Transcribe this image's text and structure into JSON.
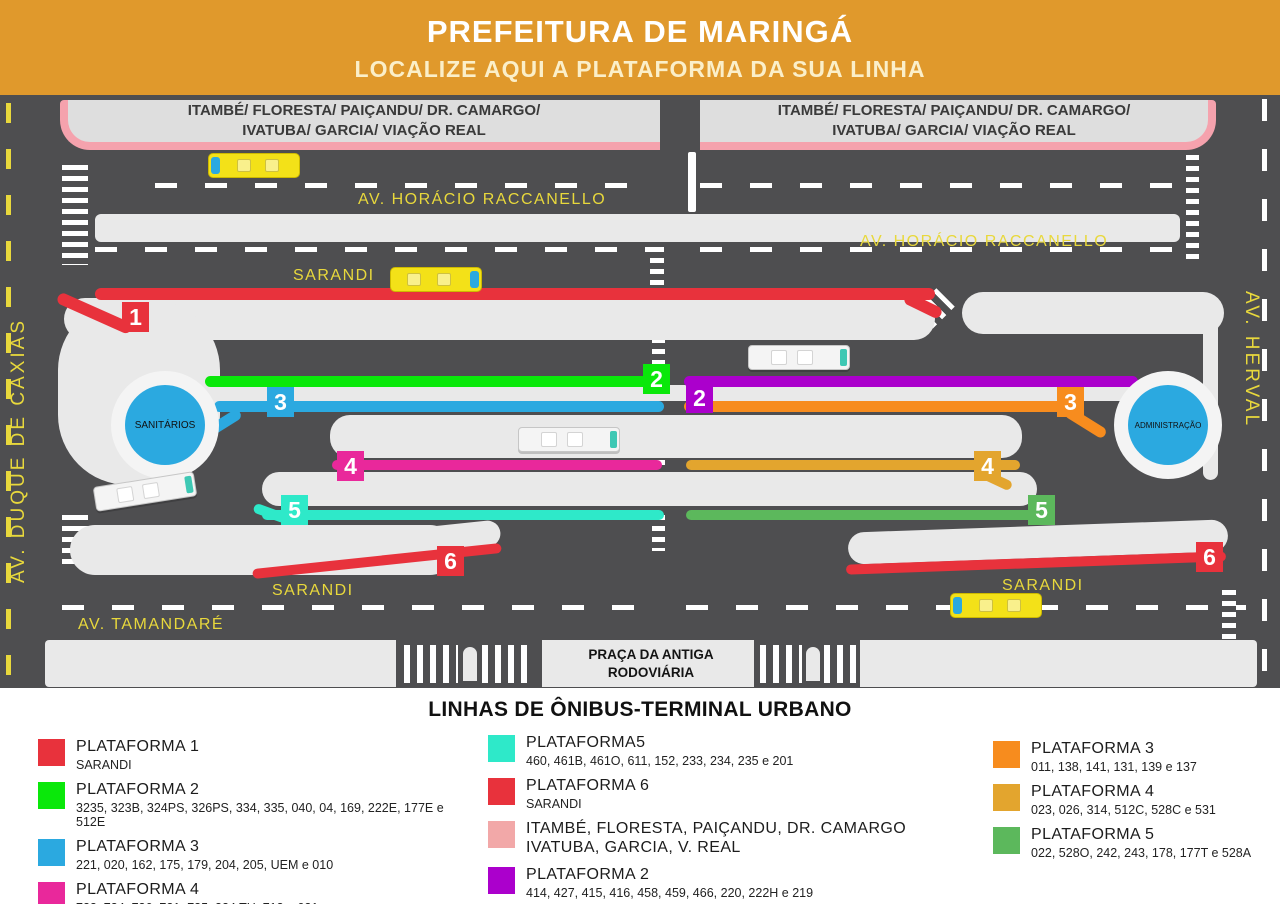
{
  "header": {
    "title": "PREFEITURA DE MARINGÁ",
    "subtitle": "LOCALIZE AQUI A PLATAFORMA DA SUA LINHA"
  },
  "map": {
    "banner_left": {
      "line1": "ITAMBÉ/ FLORESTA/ PAIÇANDU/ DR. CAMARGO/",
      "line2": "IVATUBA/ GARCIA/ VIAÇÃO REAL"
    },
    "banner_right": {
      "line1": "ITAMBÉ/ FLORESTA/ PAIÇANDU/ DR. CAMARGO/",
      "line2": "IVATUBA/ GARCIA/ VIAÇÃO REAL"
    },
    "streets": {
      "duque_de_caxias": "AV. DUQUE DE CAXIAS",
      "herval": "AV. HERVAL",
      "horacio_raccanello_1": "AV. HORÁCIO RACCANELLO",
      "horacio_raccanello_2": "AV. HORÁCIO RACCANELLO",
      "sarandi_top": "SARANDI",
      "sarandi_bottom_left": "SARANDI",
      "sarandi_bottom_right": "SARANDI",
      "tamandare": "AV. TAMANDARÉ",
      "praca_line1": "PRAÇA DA ANTIGA",
      "praca_line2": "RODOVIÁRIA"
    },
    "facilities": {
      "sanitarios": "SANITÁRIOS",
      "administracao": "ADMINISTRAÇÃO"
    },
    "badges": [
      {
        "n": "1",
        "c": "#E8323C"
      },
      {
        "n": "2",
        "c": "#0AE80A"
      },
      {
        "n": "2",
        "c": "#AB00CC"
      },
      {
        "n": "3",
        "c": "#2BA9E0"
      },
      {
        "n": "3",
        "c": "#F78C1E"
      },
      {
        "n": "4",
        "c": "#E9289B"
      },
      {
        "n": "4",
        "c": "#E3A52E"
      },
      {
        "n": "5",
        "c": "#2EE9C9"
      },
      {
        "n": "5",
        "c": "#5CB85C"
      },
      {
        "n": "6",
        "c": "#E8323C"
      },
      {
        "n": "6",
        "c": "#E8323C"
      }
    ]
  },
  "legend": {
    "title": "LINHAS DE ÔNIBUS-TERMINAL URBANO",
    "items": [
      {
        "c": "#E8323C",
        "t": "PLATAFORMA 1",
        "r": "SARANDI"
      },
      {
        "c": "#0AE80A",
        "t": "PLATAFORMA 2",
        "r": "3235, 323B, 324PS, 326PS, 334, 335, 040, 04, 169, 222E, 177E e 512E"
      },
      {
        "c": "#2BA9E0",
        "t": "PLATAFORMA 3",
        "r": "221, 020, 162, 175, 179, 204, 205, UEM e 010"
      },
      {
        "c": "#E9289B",
        "t": "PLATAFORMA 4",
        "r": "722, 734, 736, 721, 735, 324 TH, 713 e 021"
      },
      {
        "c": "#2EE9C9",
        "t": "PLATAFORMA5",
        "r": "460, 461B, 461O, 611, 152, 233, 234, 235 e 201"
      },
      {
        "c": "#E8323C",
        "t": "PLATAFORMA 6",
        "r": "SARANDI"
      },
      {
        "c": "#F2A8A8",
        "t": "ITAMBÉ, FLORESTA, PAIÇANDU, DR. CAMARGO",
        "r": "IVATUBA, GARCIA, V. REAL"
      },
      {
        "c": "#AB00CC",
        "t": "PLATAFORMA 2",
        "r": "414, 427, 415, 416, 458, 459, 466, 220, 222H e 219"
      },
      {
        "c": "#F78C1E",
        "t": "PLATAFORMA 3",
        "r": "011, 138, 141, 131, 139 e 137"
      },
      {
        "c": "#E3A52E",
        "t": "PLATAFORMA 4",
        "r": "023, 026, 314, 512C, 528C e 531"
      },
      {
        "c": "#5CB85C",
        "t": "PLATAFORMA 5",
        "r": "022, 528O, 242, 243, 178, 177T e 528A"
      }
    ]
  },
  "colors": {
    "header_orange": "#E0992C",
    "subtitle_cream": "#FBEFC9",
    "map_background": "#4E4E50",
    "island_gray": "#E9E9E9",
    "banner_gray": "#DEDEDE",
    "banner_pink": "#F5A2AD",
    "street_label_yellow": "#E8D83C",
    "facility_blue": "#2BA9E0",
    "bus_yellow": "#F3E118",
    "bus_teal": "#3EC8B4"
  }
}
